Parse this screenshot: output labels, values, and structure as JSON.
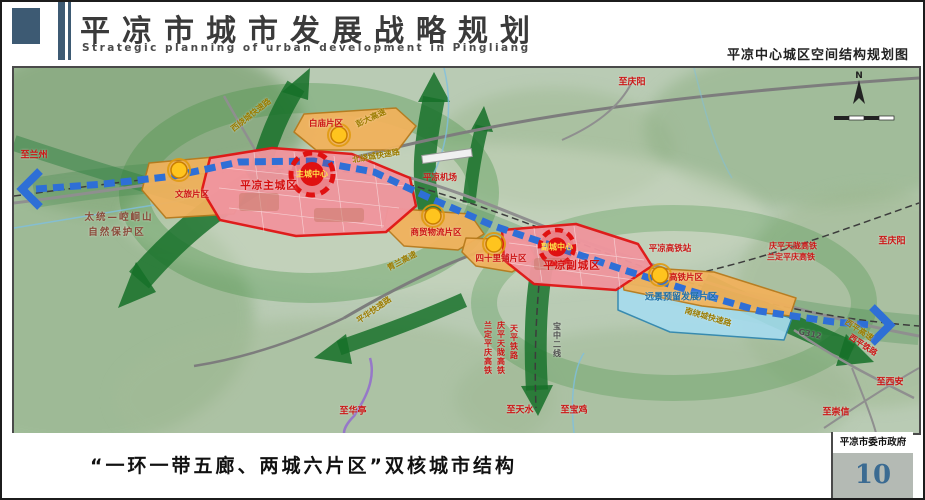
{
  "header": {
    "title": "平凉市城市发展战略规划",
    "subtitle": "Strategic planning of urban development in Pingliang",
    "map_title": "平凉中心城区空间结构规划图"
  },
  "footer": {
    "caption": "“一环一带五廊、两城六片区”双核城市结构",
    "agency": "平凉市委市政府",
    "page_number": "10"
  },
  "colors": {
    "brand_blue": "#3d5a73",
    "city_red": "#e01616",
    "zone_orange": "#f1b25c",
    "reserve_blue": "#a6dcee",
    "corridor_green": "#157028",
    "transit_blue": "#2e6fd6",
    "page_number_blue": "#3b6b92"
  },
  "map": {
    "compass_label": "N",
    "labels": [
      {
        "text": "至兰州",
        "x": 20,
        "y": 86,
        "rot": 0,
        "cls": "dest",
        "vert": false
      },
      {
        "text": "太统—崆峒山",
        "x": 105,
        "y": 148,
        "rot": 0,
        "cls": "nature",
        "vert": false
      },
      {
        "text": "自然保护区",
        "x": 103,
        "y": 163,
        "rot": 0,
        "cls": "nature",
        "vert": false
      },
      {
        "text": "文旅片区",
        "x": 178,
        "y": 126,
        "rot": 0,
        "cls": "zone",
        "vert": false
      },
      {
        "text": "西绕城快速路",
        "x": 237,
        "y": 47,
        "rot": -38,
        "cls": "road",
        "vert": false
      },
      {
        "text": "白庙片区",
        "x": 312,
        "y": 55,
        "rot": 0,
        "cls": "zone",
        "vert": false
      },
      {
        "text": "彭大高速",
        "x": 357,
        "y": 50,
        "rot": -25,
        "cls": "road",
        "vert": false
      },
      {
        "text": "北绕城快速路",
        "x": 362,
        "y": 88,
        "rot": -10,
        "cls": "road",
        "vert": false
      },
      {
        "text": "平凉主城区",
        "x": 255,
        "y": 117,
        "rot": 0,
        "cls": "city",
        "vert": false
      },
      {
        "text": "主城中心",
        "x": 298,
        "y": 106,
        "rot": 0,
        "cls": "center",
        "vert": false
      },
      {
        "text": "平凉机场",
        "x": 426,
        "y": 109,
        "rot": 0,
        "cls": "zone",
        "vert": false
      },
      {
        "text": "商贸物流片区",
        "x": 422,
        "y": 164,
        "rot": 0,
        "cls": "zone",
        "vert": false
      },
      {
        "text": "青兰高速",
        "x": 388,
        "y": 193,
        "rot": -28,
        "cls": "road",
        "vert": false
      },
      {
        "text": "四十里铺片区",
        "x": 487,
        "y": 190,
        "rot": 0,
        "cls": "zone",
        "vert": false
      },
      {
        "text": "平凉副城区",
        "x": 558,
        "y": 197,
        "rot": 0,
        "cls": "city",
        "vert": false
      },
      {
        "text": "副城中心",
        "x": 543,
        "y": 179,
        "rot": 0,
        "cls": "center",
        "vert": false
      },
      {
        "text": "平凉高铁站",
        "x": 656,
        "y": 180,
        "rot": 0,
        "cls": "zone",
        "vert": false
      },
      {
        "text": "高铁片区",
        "x": 672,
        "y": 209,
        "rot": 0,
        "cls": "zone",
        "vert": false
      },
      {
        "text": "远景预留发展片区",
        "x": 667,
        "y": 228,
        "rot": 0,
        "cls": "blue",
        "vert": false
      },
      {
        "text": "庆平天陇高铁",
        "x": 779,
        "y": 178,
        "rot": 0,
        "cls": "rail",
        "vert": false
      },
      {
        "text": "兰定平庆高铁",
        "x": 777,
        "y": 189,
        "rot": 0,
        "cls": "rail",
        "vert": false
      },
      {
        "text": "至庆阳",
        "x": 878,
        "y": 172,
        "rot": 0,
        "cls": "dest",
        "vert": false
      },
      {
        "text": "至庆阳",
        "x": 618,
        "y": 13,
        "rot": 0,
        "cls": "dest",
        "vert": false
      },
      {
        "text": "西平高速",
        "x": 845,
        "y": 262,
        "rot": 33,
        "cls": "road",
        "vert": false
      },
      {
        "text": "西平铁路",
        "x": 849,
        "y": 277,
        "rot": 33,
        "cls": "rail",
        "vert": false
      },
      {
        "text": "G312",
        "x": 796,
        "y": 266,
        "rot": 12,
        "cls": "gray",
        "vert": false
      },
      {
        "text": "至西安",
        "x": 876,
        "y": 313,
        "rot": 0,
        "cls": "dest",
        "vert": false
      },
      {
        "text": "至崇信",
        "x": 822,
        "y": 343,
        "rot": 0,
        "cls": "dest",
        "vert": false
      },
      {
        "text": "南绕城快速路",
        "x": 694,
        "y": 249,
        "rot": 16,
        "cls": "road",
        "vert": false
      },
      {
        "text": "平华快速路",
        "x": 360,
        "y": 242,
        "rot": -35,
        "cls": "road",
        "vert": false
      },
      {
        "text": "至华亭",
        "x": 339,
        "y": 342,
        "rot": 0,
        "cls": "dest",
        "vert": false
      },
      {
        "text": "天平铁路",
        "x": 500,
        "y": 274,
        "rot": 0,
        "cls": "rail",
        "vert": true
      },
      {
        "text": "庆平天陇高铁",
        "x": 487,
        "y": 280,
        "rot": 0,
        "cls": "rail",
        "vert": true
      },
      {
        "text": "兰定平庆高铁",
        "x": 474,
        "y": 280,
        "rot": 0,
        "cls": "rail",
        "vert": true
      },
      {
        "text": "宝中二线",
        "x": 543,
        "y": 272,
        "rot": 0,
        "cls": "gray",
        "vert": true
      },
      {
        "text": "至天水",
        "x": 506,
        "y": 341,
        "rot": 0,
        "cls": "dest",
        "vert": false
      },
      {
        "text": "至宝鸡",
        "x": 560,
        "y": 341,
        "rot": 0,
        "cls": "dest",
        "vert": false
      }
    ]
  }
}
